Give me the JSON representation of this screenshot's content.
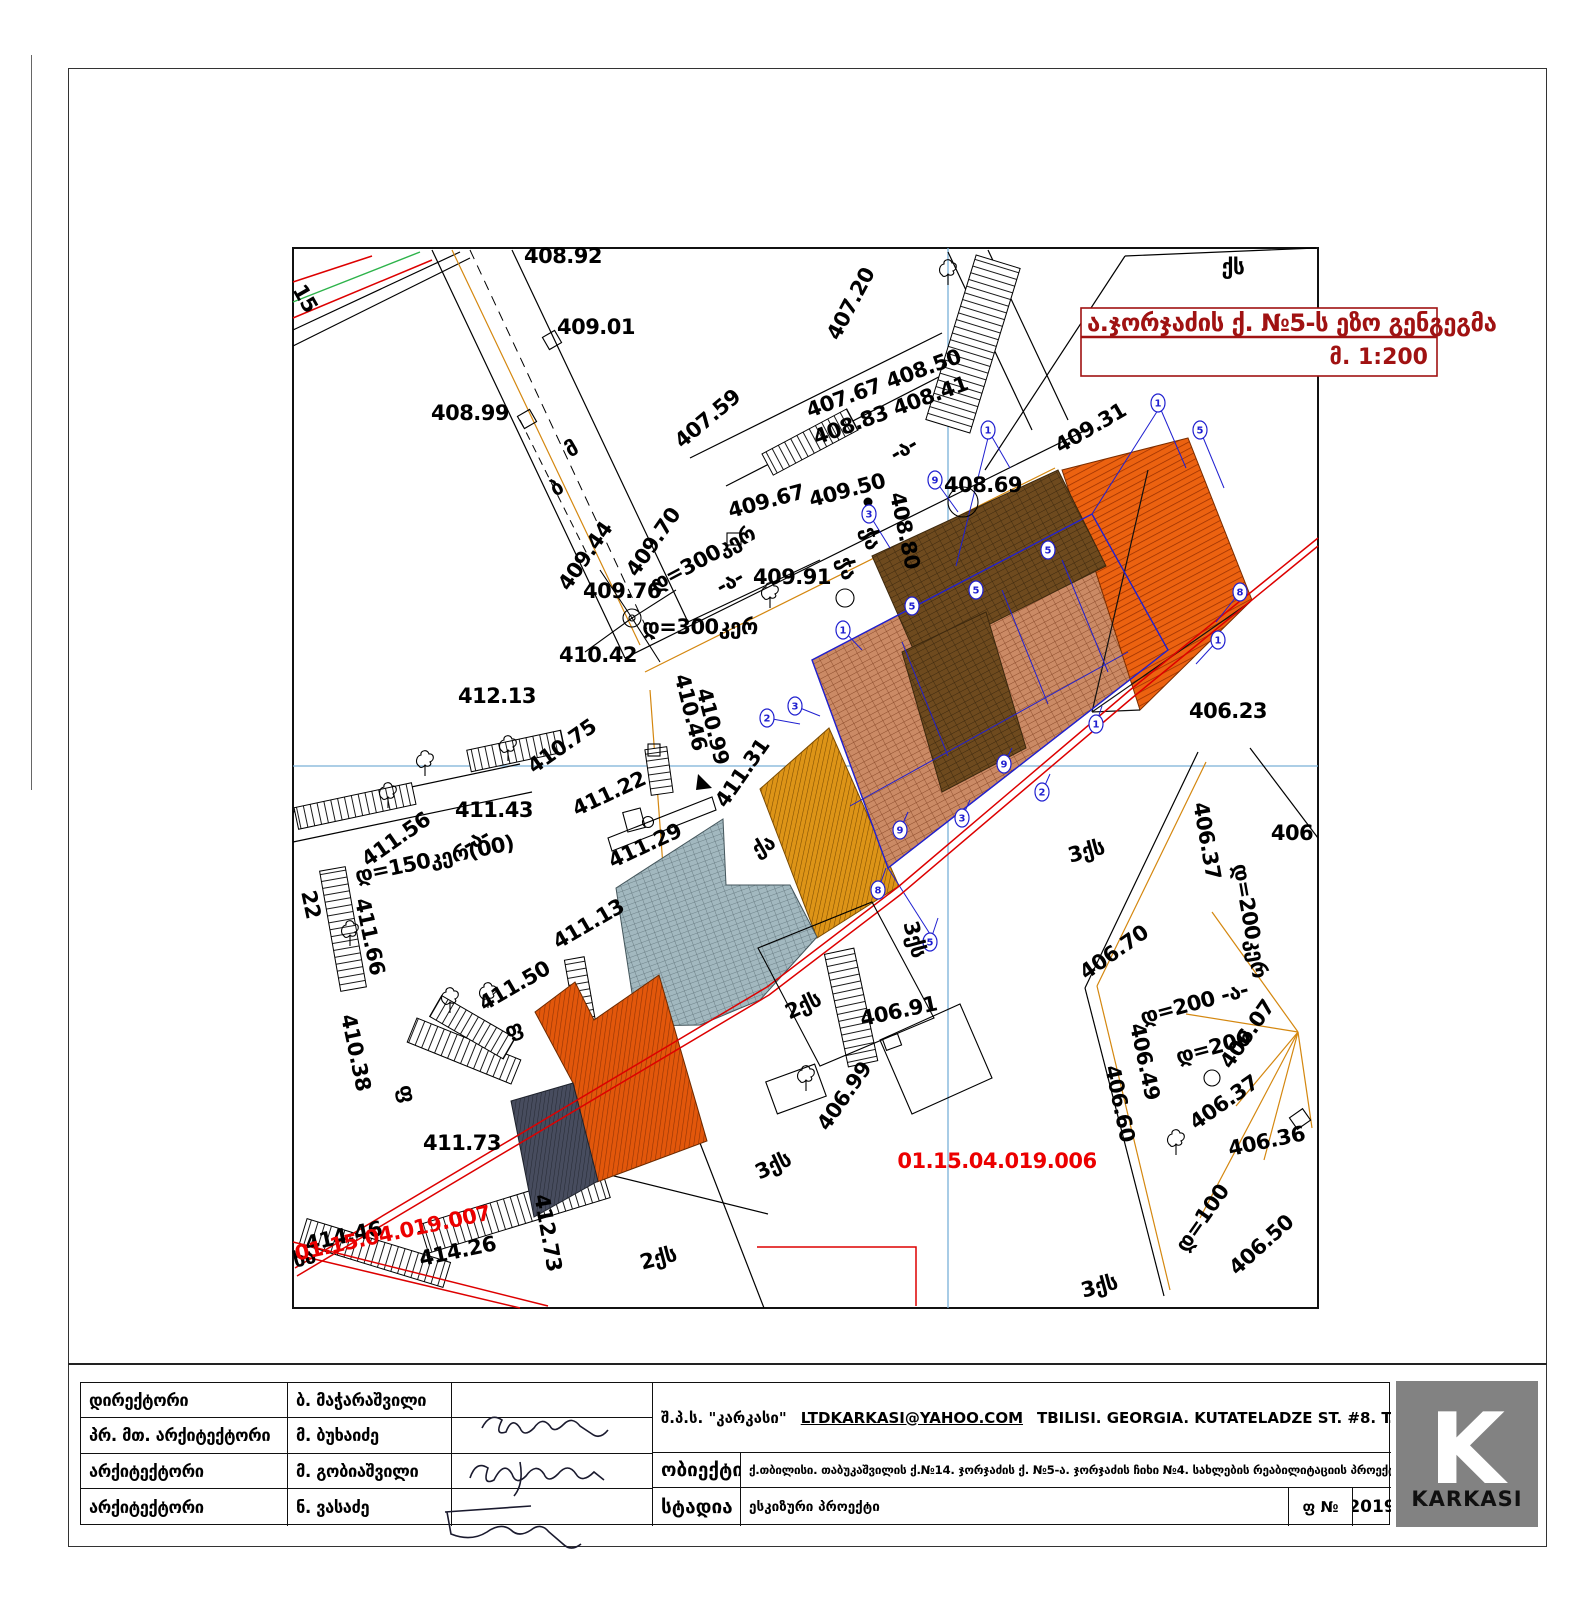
{
  "title_box": {
    "line1": "ა.ჯორჯაძის ქ. №5-ს ეზო გენგეგმა",
    "line2": "მ. 1:200"
  },
  "title_block": {
    "rows": [
      {
        "role": "დირექტორი",
        "name": "ბ. მაჭარაშვილი"
      },
      {
        "role": "პრ. მთ. არქიტექტორი",
        "name": "მ. ბუხაიძე"
      },
      {
        "role": "არქიტექტორი",
        "name": "მ. გობიაშვილი"
      },
      {
        "role": "არქიტექტორი",
        "name": "ნ. ვასაძე"
      }
    ],
    "company": "შ.პ.ს. \"კარკასი\"",
    "email": "LTDKARKASI@YAHOO.COM",
    "address": "TBILISI. GEORGIA. KUTATELADZE ST. #8. T. 599 144226\"\"",
    "object_label": "ობიექტი",
    "object_text": "ქ.თბილისი. თაბუკაშვილის ქ.№14. ჯორჯაძის ქ. №5-ა. ჯორჯაძის ჩიხი №4. სახლების რეაბილიტაციის პროექტი",
    "stage_label": "სტადია",
    "stage_text": "ესკიზური პროექტი",
    "sheet_label": "ფ №",
    "year": "2019",
    "logo_letter": "K",
    "logo_text": "KARKASI"
  },
  "colors": {
    "title_red": "#a01212",
    "parcel_red": "#ec0000",
    "boundary_red": "#dd0000",
    "grid_blue": "#7ab0d8",
    "axis_blue": "#2020d0",
    "utility_orange": "#d4870f",
    "roof_brick": "#cb8a65",
    "roof_brick_dark": "#6e4a1e",
    "roof_orange": "#ec6210",
    "roof_gold": "#dd9417",
    "roof_gray": "#a2b8bf",
    "roof_orange2": "#e2570b",
    "roof_navy": "#474c5e",
    "logo_gray": "#828282"
  },
  "map": {
    "labels": [
      {
        "t": "408.92",
        "x": 563,
        "y": 263,
        "r": 0
      },
      {
        "t": "409.01",
        "x": 596,
        "y": 334,
        "r": 0
      },
      {
        "t": "408.99",
        "x": 470,
        "y": 420,
        "r": 0
      },
      {
        "t": "15",
        "x": 299,
        "y": 302,
        "r": 60
      },
      {
        "t": "407.20",
        "x": 857,
        "y": 307,
        "r": -62
      },
      {
        "t": "407.59",
        "x": 712,
        "y": 424,
        "r": -40
      },
      {
        "t": "407.67 408.50",
        "x": 886,
        "y": 390,
        "r": -20
      },
      {
        "t": "408.83  408.41",
        "x": 893,
        "y": 417,
        "r": -20
      },
      {
        "t": "409.67",
        "x": 768,
        "y": 508,
        "r": -15
      },
      {
        "t": "409.50",
        "x": 849,
        "y": 497,
        "r": -15
      },
      {
        "t": "408.80",
        "x": 898,
        "y": 532,
        "r": 78
      },
      {
        "t": "408.69",
        "x": 983,
        "y": 492,
        "r": 0
      },
      {
        "t": "409.31",
        "x": 1094,
        "y": 434,
        "r": -30
      },
      {
        "t": "409.70",
        "x": 659,
        "y": 546,
        "r": -55
      },
      {
        "t": "409.44",
        "x": 591,
        "y": 560,
        "r": -55
      },
      {
        "t": "დ=300კერ",
        "x": 706,
        "y": 565,
        "r": -28,
        "s": 19
      },
      {
        "t": "-ა-",
        "x": 733,
        "y": 588,
        "r": -28,
        "s": 18
      },
      {
        "t": "409.76",
        "x": 622,
        "y": 598,
        "r": 0
      },
      {
        "t": "409.91",
        "x": 792,
        "y": 584,
        "r": 0
      },
      {
        "t": "დ=300კერ",
        "x": 700,
        "y": 634,
        "r": 0,
        "s": 19
      },
      {
        "t": "410.42",
        "x": 598,
        "y": 662,
        "r": 0
      },
      {
        "t": "412.13",
        "x": 497,
        "y": 703,
        "r": 0
      },
      {
        "t": "410.46",
        "x": 684,
        "y": 714,
        "r": 76
      },
      {
        "t": "410.99",
        "x": 706,
        "y": 728,
        "r": 76
      },
      {
        "t": "410.75",
        "x": 566,
        "y": 752,
        "r": -35
      },
      {
        "t": "411.31",
        "x": 748,
        "y": 777,
        "r": -55
      },
      {
        "t": "411.22",
        "x": 612,
        "y": 800,
        "r": -25
      },
      {
        "t": "411.43",
        "x": 494,
        "y": 817,
        "r": 0
      },
      {
        "t": "411.56",
        "x": 400,
        "y": 845,
        "r": -35
      },
      {
        "t": "დ=150კერ(00)",
        "x": 436,
        "y": 866,
        "r": -12,
        "s": 18
      },
      {
        "t": "-ა-",
        "x": 479,
        "y": 846,
        "r": -30,
        "s": 18
      },
      {
        "t": "411.29",
        "x": 648,
        "y": 852,
        "r": -25
      },
      {
        "t": "411.66",
        "x": 363,
        "y": 938,
        "r": 78
      },
      {
        "t": "411.13",
        "x": 592,
        "y": 930,
        "r": -30
      },
      {
        "t": "411.50",
        "x": 518,
        "y": 992,
        "r": -30
      },
      {
        "t": "22",
        "x": 304,
        "y": 906,
        "r": 78,
        "s": 19
      },
      {
        "t": "410.38",
        "x": 349,
        "y": 1054,
        "r": 78
      },
      {
        "t": "411.73",
        "x": 462,
        "y": 1150,
        "r": 0
      },
      {
        "t": "414.46",
        "x": 345,
        "y": 1243,
        "r": -12
      },
      {
        "t": "414.26",
        "x": 459,
        "y": 1258,
        "r": -12
      },
      {
        "t": "412.73",
        "x": 541,
        "y": 1234,
        "r": 80
      },
      {
        "t": "406.23",
        "x": 1228,
        "y": 718,
        "r": 0
      },
      {
        "t": "406.37",
        "x": 1200,
        "y": 842,
        "r": 80
      },
      {
        "t": "406",
        "x": 1292,
        "y": 840,
        "r": 0
      },
      {
        "t": "406.70",
        "x": 1118,
        "y": 958,
        "r": -35
      },
      {
        "t": "406.91",
        "x": 900,
        "y": 1018,
        "r": -12
      },
      {
        "t": "406.99",
        "x": 850,
        "y": 1100,
        "r": -55
      },
      {
        "t": "დ=200კერ",
        "x": 1243,
        "y": 922,
        "r": 80,
        "s": 19
      },
      {
        "t": "დ=200 -ა-",
        "x": 1196,
        "y": 1010,
        "r": -15,
        "s": 19
      },
      {
        "t": "დ=200",
        "x": 1215,
        "y": 1054,
        "r": -15,
        "s": 19
      },
      {
        "t": "406.49",
        "x": 1138,
        "y": 1063,
        "r": 78
      },
      {
        "t": "406.60",
        "x": 1113,
        "y": 1105,
        "r": 78
      },
      {
        "t": "406.07",
        "x": 1253,
        "y": 1038,
        "r": -55
      },
      {
        "t": "406.37",
        "x": 1228,
        "y": 1108,
        "r": -35
      },
      {
        "t": "406.36",
        "x": 1268,
        "y": 1148,
        "r": -12
      },
      {
        "t": "დ=100",
        "x": 1208,
        "y": 1222,
        "r": -55,
        "s": 19
      },
      {
        "t": "406.50",
        "x": 1266,
        "y": 1250,
        "r": -42
      },
      {
        "t": "ქს",
        "x": 1233,
        "y": 274,
        "r": 0,
        "s": 19
      },
      {
        "t": "ჭა",
        "x": 840,
        "y": 570,
        "r": 75,
        "s": 19
      },
      {
        "t": "ჭა",
        "x": 864,
        "y": 540,
        "r": 75,
        "s": 19
      },
      {
        "t": "ქა",
        "x": 767,
        "y": 852,
        "r": -30,
        "s": 19
      },
      {
        "t": "2ქს",
        "x": 806,
        "y": 1012,
        "r": -25,
        "s": 19
      },
      {
        "t": "3ქს",
        "x": 908,
        "y": 941,
        "r": 75,
        "s": 19
      },
      {
        "t": "3ქს",
        "x": 776,
        "y": 1172,
        "r": -25,
        "s": 19
      },
      {
        "t": "3ქს",
        "x": 1088,
        "y": 858,
        "r": -15,
        "s": 19
      },
      {
        "t": "2ქს",
        "x": 660,
        "y": 1265,
        "r": -15,
        "s": 19
      },
      {
        "t": "3ქს",
        "x": 1101,
        "y": 1293,
        "r": -15,
        "s": 19
      },
      {
        "t": "ხა",
        "x": 306,
        "y": 1265,
        "r": -15,
        "s": 19
      },
      {
        "t": "ფ",
        "x": 516,
        "y": 1036,
        "r": -20,
        "s": 19
      },
      {
        "t": "ფ",
        "x": 400,
        "y": 1095,
        "r": 78,
        "s": 19
      },
      {
        "t": "-ა-",
        "x": 907,
        "y": 455,
        "r": -30,
        "s": 18
      },
      {
        "t": "მ",
        "x": 575,
        "y": 455,
        "r": -30,
        "s": 17
      },
      {
        "t": "ბ",
        "x": 560,
        "y": 494,
        "r": -30,
        "s": 17
      },
      {
        "t": "01.15.04.019.006",
        "x": 997,
        "y": 1168,
        "r": 0,
        "c": "red",
        "s": 24
      },
      {
        "t": "01.15.04.019.007",
        "x": 394,
        "y": 1240,
        "r": -12,
        "c": "red",
        "s": 21
      }
    ],
    "axis_circles": [
      {
        "x": 1158,
        "y": 403,
        "n": "1",
        "l": [
          1186,
          468
        ]
      },
      {
        "x": 1200,
        "y": 430,
        "n": "5",
        "l": [
          1224,
          488
        ]
      },
      {
        "x": 988,
        "y": 430,
        "n": "1",
        "l": [
          1010,
          468
        ]
      },
      {
        "x": 935,
        "y": 480,
        "n": "9",
        "l": [
          958,
          512
        ]
      },
      {
        "x": 869,
        "y": 514,
        "n": "3",
        "l": [
          890,
          548
        ]
      },
      {
        "x": 1240,
        "y": 592,
        "n": "8",
        "l": [
          1216,
          622
        ]
      },
      {
        "x": 1218,
        "y": 640,
        "n": "1",
        "l": [
          1196,
          664
        ]
      },
      {
        "x": 795,
        "y": 706,
        "n": "3",
        "l": [
          820,
          716
        ]
      },
      {
        "x": 767,
        "y": 718,
        "n": "2",
        "l": [
          800,
          724
        ]
      },
      {
        "x": 843,
        "y": 630,
        "n": "1",
        "l": [
          862,
          650
        ]
      },
      {
        "x": 878,
        "y": 890,
        "n": "8",
        "l": [
          886,
          868
        ]
      },
      {
        "x": 900,
        "y": 830,
        "n": "9",
        "l": [
          908,
          812
        ]
      },
      {
        "x": 930,
        "y": 942,
        "n": "5",
        "l": [
          938,
          918
        ]
      },
      {
        "x": 962,
        "y": 818,
        "n": "3",
        "l": [
          970,
          800
        ]
      },
      {
        "x": 1004,
        "y": 764,
        "n": "9",
        "l": [
          1012,
          748
        ]
      },
      {
        "x": 1042,
        "y": 792,
        "n": "2",
        "l": [
          1050,
          774
        ]
      },
      {
        "x": 1096,
        "y": 724,
        "n": "1",
        "l": [
          1102,
          706
        ]
      },
      {
        "x": 912,
        "y": 606,
        "n": "5"
      },
      {
        "x": 976,
        "y": 590,
        "n": "5"
      },
      {
        "x": 1048,
        "y": 550,
        "n": "5"
      }
    ],
    "trees": [
      {
        "x": 388,
        "y": 795
      },
      {
        "x": 350,
        "y": 933
      },
      {
        "x": 450,
        "y": 1000
      },
      {
        "x": 488,
        "y": 995
      },
      {
        "x": 508,
        "y": 748
      },
      {
        "x": 770,
        "y": 595
      },
      {
        "x": 948,
        "y": 272
      },
      {
        "x": 806,
        "y": 1078
      },
      {
        "x": 1176,
        "y": 1142
      },
      {
        "x": 425,
        "y": 763
      }
    ]
  }
}
